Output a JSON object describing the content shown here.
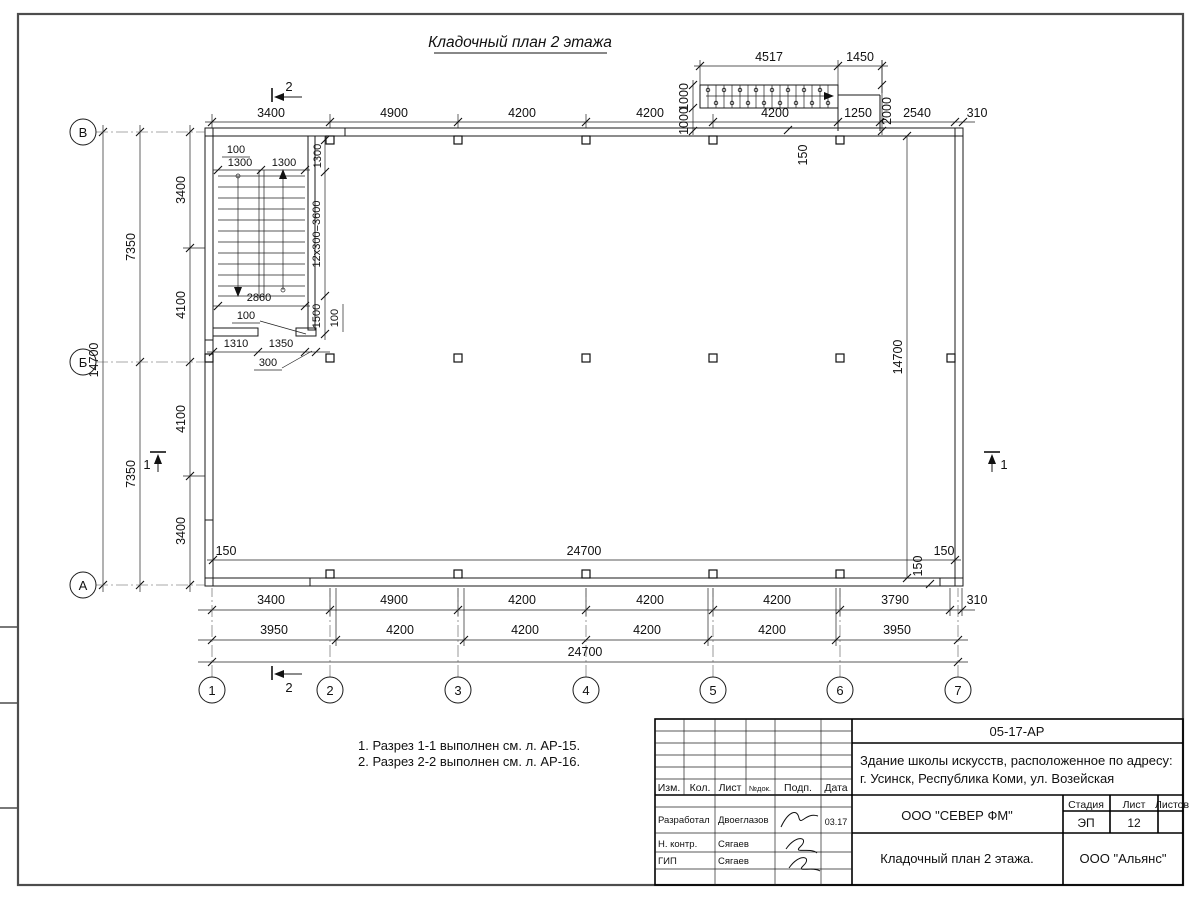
{
  "sheet": {
    "title": "Кладочный план 2 этажа"
  },
  "axes": {
    "horizontal": [
      "1",
      "2",
      "3",
      "4",
      "5",
      "6",
      "7"
    ],
    "vertical": [
      "В",
      "Б",
      "А"
    ]
  },
  "sections": {
    "s1": "1",
    "s2": "2"
  },
  "dims": {
    "top_row": [
      "3400",
      "4900",
      "4200",
      "4200",
      "4200",
      "1250",
      "2540",
      "310"
    ],
    "ext_top": [
      "4517",
      "1450"
    ],
    "ext_left": [
      "1000",
      "1000"
    ],
    "ext_right": "2000",
    "ext_offset": "150",
    "left_outer": "14700",
    "left_mid": [
      "7350",
      "7350"
    ],
    "left_inner": [
      "3400",
      "4100",
      "4100",
      "3400"
    ],
    "right_inner": "14700",
    "inner_bottom": [
      "150",
      "24700",
      "150"
    ],
    "wall_offset_br": "150",
    "bottom_row1": [
      "3400",
      "4900",
      "4200",
      "4200",
      "4200",
      "3790",
      "310"
    ],
    "bottom_row2": [
      "3950",
      "4200",
      "4200",
      "4200",
      "4200",
      "3950"
    ],
    "bottom_total": "24700",
    "stair": {
      "top100": "100",
      "flight_a": "1300",
      "flight_b": "1300",
      "right1300": "1300",
      "steps": "12x300=3600",
      "w2860": "2860",
      "mid100": "100",
      "right1500": "1500",
      "right100": "100",
      "b1310": "1310",
      "b1350": "1350",
      "pier300": "300"
    }
  },
  "notes": [
    "1. Разрез 1-1 выполнен см. л. АР-15.",
    "2. Разрез 2-2 выполнен см. л. АР-16."
  ],
  "titleblock": {
    "doc_code": "05-17-АР",
    "project_line1": "Здание школы искусств, расположенное по адресу:",
    "project_line2": "г. Усинск, Республика Коми, ул. Возейская",
    "header": [
      "Изм.",
      "Кол.",
      "Лист",
      "№док.",
      "Подп.",
      "Дата"
    ],
    "row1_role": "Разработал",
    "row1_name": "Двоеглазов",
    "row1_date": "03.17",
    "row2_role": "Н. контр.",
    "row2_name": "Сягаев",
    "row3_role": "ГИП",
    "row3_name": "Сягаев",
    "company": "ООО \"СЕВЕР ФМ\"",
    "stage_label": "Стадия",
    "sheet_label": "Лист",
    "sheets_label": "Листов",
    "stage": "ЭП",
    "sheet_no": "12",
    "drawing_title": "Кладочный план 2 этажа.",
    "contractor": "ООО \"Альянс\""
  }
}
